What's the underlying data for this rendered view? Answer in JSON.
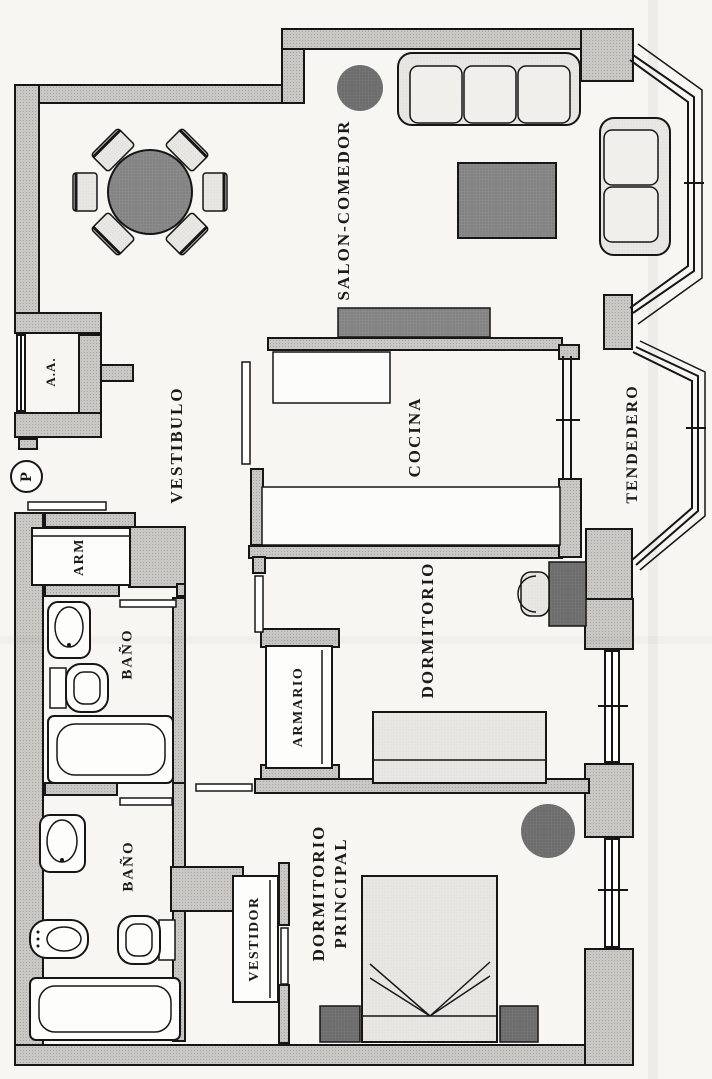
{
  "labels": {
    "salon_comedor": "SALON-COMEDOR",
    "vestibulo": "VESTIBULO",
    "cocina": "COCINA",
    "tendedero": "TENDEDERO",
    "dormitorio": "DORMITORIO",
    "armario": "ARMARIO",
    "arm_closet": "ARM",
    "bano_upper": "BAÑO",
    "bano_lower": "BAÑO",
    "dormitorio_principal_line1": "DORMITORIO",
    "dormitorio_principal_line2": "PRINCIPAL",
    "vestidor": "VESTIDOR",
    "aa_unit": "A.A.",
    "entrance_marker": "P"
  },
  "colors": {
    "paper": "#f7f6f3",
    "wall": "#c9c8c5",
    "line": "#161616",
    "furniture_dark": "#8a8a8a",
    "furniture_light": "#e8e7e4"
  }
}
